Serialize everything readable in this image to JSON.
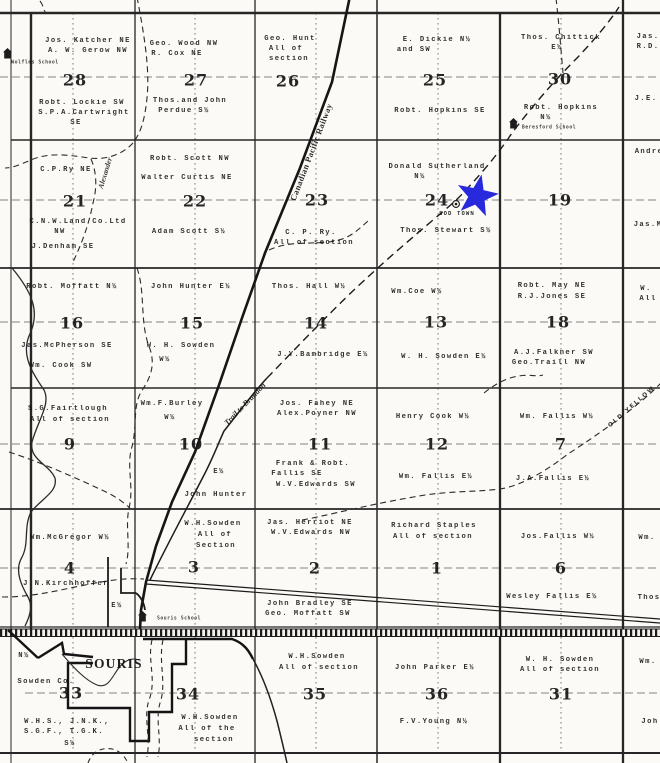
{
  "palette": {
    "paper": "#fbfaf6",
    "ink": "#1c1c1c",
    "grid": "#262626",
    "quarter_dash": "#5d5d5d",
    "star": "#2828dc"
  },
  "star": {
    "color": "#2828dc"
  },
  "schools": [
    {
      "name": "wolfles-school",
      "label": "Wolfles School",
      "icon_x": 3,
      "icon_y": 46,
      "label_x": 35,
      "label_y": 63
    },
    {
      "name": "beresford-school",
      "label": "Beresford School",
      "icon_x": 509,
      "icon_y": 116,
      "label_x": 549,
      "label_y": 128
    },
    {
      "name": "souris-school",
      "label": "Souris School",
      "icon_x": 138,
      "icon_y": 609,
      "label_x": 179,
      "label_y": 619
    }
  ],
  "labels": [
    {
      "name": "s28-owner-ne",
      "text": "Jos. Katcher NE",
      "x": 88,
      "y": 41
    },
    {
      "name": "s28-owner-nw",
      "text": "A. W. Gerow  NW",
      "x": 88,
      "y": 51
    },
    {
      "name": "s28-number",
      "text": "28",
      "x": 75,
      "y": 80,
      "kind": "number"
    },
    {
      "name": "s28-owner-sw",
      "text": "Robt. Lockie SW",
      "x": 82,
      "y": 103
    },
    {
      "name": "s28-owner-se",
      "text": "S.P.A.Cartwright",
      "x": 84,
      "y": 113
    },
    {
      "name": "s28-owner-se-2",
      "text": "SE",
      "x": 76,
      "y": 123
    },
    {
      "name": "s27-owner-nw",
      "text": "Geo. Wood  NW",
      "x": 184,
      "y": 44
    },
    {
      "name": "s27-owner-ne",
      "text": "R. Cox  NE",
      "x": 177,
      "y": 54
    },
    {
      "name": "s27-number",
      "text": "27",
      "x": 196,
      "y": 80,
      "kind": "number"
    },
    {
      "name": "s27-owner-s",
      "text": "Thos.and John",
      "x": 190,
      "y": 101
    },
    {
      "name": "s27-owner-s-2",
      "text": "Perdue  S½",
      "x": 184,
      "y": 111
    },
    {
      "name": "s26-owner-1",
      "text": "Geo. Hunt",
      "x": 290,
      "y": 39
    },
    {
      "name": "s26-owner-2",
      "text": "All of",
      "x": 286,
      "y": 49
    },
    {
      "name": "s26-owner-3",
      "text": "section",
      "x": 289,
      "y": 59
    },
    {
      "name": "s26-number",
      "text": "26",
      "x": 288,
      "y": 81,
      "kind": "number"
    },
    {
      "name": "s25-owner-n",
      "text": "E. Dickie N½",
      "x": 437,
      "y": 40
    },
    {
      "name": "s25-owner-n-2",
      "text": "and SW",
      "x": 414,
      "y": 50
    },
    {
      "name": "s25-number",
      "text": "25",
      "x": 435,
      "y": 80,
      "kind": "number"
    },
    {
      "name": "s25-owner-se",
      "text": "Robt. Hopkins SE",
      "x": 440,
      "y": 111
    },
    {
      "name": "s30-owner-e",
      "text": "Thos. Chittick",
      "x": 561,
      "y": 38
    },
    {
      "name": "s30-owner-e-2",
      "text": "E½",
      "x": 557,
      "y": 48
    },
    {
      "name": "s30-number",
      "text": "30",
      "x": 560,
      "y": 79,
      "kind": "number"
    },
    {
      "name": "s30-owner-n",
      "text": "Robt. Hopkins",
      "x": 561,
      "y": 108
    },
    {
      "name": "s30-owner-n-2",
      "text": "N½",
      "x": 546,
      "y": 118
    },
    {
      "name": "edge-ne-owner-1",
      "text": "Jas.",
      "x": 648,
      "y": 37
    },
    {
      "name": "edge-ne-owner-2",
      "text": "R.D.",
      "x": 648,
      "y": 47
    },
    {
      "name": "edge-ne-owner-3",
      "text": "J.E.",
      "x": 646,
      "y": 99
    },
    {
      "name": "s21-owner-ne",
      "text": "C.P.Ry  NE",
      "x": 66,
      "y": 170
    },
    {
      "name": "s21-number",
      "text": "21",
      "x": 75,
      "y": 201,
      "kind": "number"
    },
    {
      "name": "s21-owner-nw",
      "text": "C.N.W.Land Co.Ltd",
      "x": 78,
      "y": 222
    },
    {
      "name": "s21-owner-nw-2",
      "text": "NW",
      "x": 60,
      "y": 232
    },
    {
      "name": "s21-owner-se",
      "text": "J.Denham  SE",
      "x": 63,
      "y": 247
    },
    {
      "name": "alexander-trail-label",
      "text": "Alexander",
      "x": 105,
      "y": 173,
      "kind": "alex",
      "rot": -73
    },
    {
      "name": "s22-owner-nw",
      "text": "Robt. Scott  NW",
      "x": 190,
      "y": 159
    },
    {
      "name": "s22-owner-ne",
      "text": "Walter Curtis NE",
      "x": 187,
      "y": 178
    },
    {
      "name": "s22-number",
      "text": "22",
      "x": 195,
      "y": 201,
      "kind": "number"
    },
    {
      "name": "s22-owner-s",
      "text": "Adam Scott  S½",
      "x": 189,
      "y": 232
    },
    {
      "name": "cp-railway-label",
      "text": "Canadian Pacific Railway",
      "x": 311,
      "y": 152,
      "kind": "rail",
      "rot": -69
    },
    {
      "name": "s23-number",
      "text": "23",
      "x": 317,
      "y": 200,
      "kind": "number"
    },
    {
      "name": "s23-owner-1",
      "text": "C. P. Ry.",
      "x": 311,
      "y": 233
    },
    {
      "name": "s23-owner-2",
      "text": "All of section",
      "x": 314,
      "y": 243
    },
    {
      "name": "s24-owner-n",
      "text": "Donald Sutherland",
      "x": 437,
      "y": 167
    },
    {
      "name": "s24-owner-n-2",
      "text": "N½",
      "x": 420,
      "y": 177
    },
    {
      "name": "s24-number",
      "text": "24",
      "x": 437,
      "y": 200,
      "kind": "number"
    },
    {
      "name": "sod-town-label",
      "text": "SOD TOWN",
      "x": 457,
      "y": 214,
      "kind": "tiny"
    },
    {
      "name": "s24-owner-s",
      "text": "Thos. Stewart S½",
      "x": 446,
      "y": 231
    },
    {
      "name": "s19-number",
      "text": "19",
      "x": 560,
      "y": 200,
      "kind": "number"
    },
    {
      "name": "edge-e-owner-1",
      "text": "Andre",
      "x": 649,
      "y": 152
    },
    {
      "name": "edge-e-owner-2",
      "text": "Jas.M",
      "x": 648,
      "y": 225
    },
    {
      "name": "s16-owner-n",
      "text": "Robt. Moffatt N½",
      "x": 72,
      "y": 287
    },
    {
      "name": "s16-number",
      "text": "16",
      "x": 72,
      "y": 323,
      "kind": "number"
    },
    {
      "name": "s16-owner-se",
      "text": "Jas.McPherson SE",
      "x": 67,
      "y": 346
    },
    {
      "name": "s16-owner-sw",
      "text": "Wm. Cook  SW",
      "x": 61,
      "y": 366
    },
    {
      "name": "s15-owner-e",
      "text": "John Hunter  E½",
      "x": 191,
      "y": 287
    },
    {
      "name": "s15-number",
      "text": "15",
      "x": 192,
      "y": 323,
      "kind": "number"
    },
    {
      "name": "s15-owner-w",
      "text": "W. H. Sowden",
      "x": 181,
      "y": 346
    },
    {
      "name": "s15-owner-w-2",
      "text": "W½",
      "x": 165,
      "y": 360
    },
    {
      "name": "s14-owner-w",
      "text": "Thos. Hall  W½",
      "x": 309,
      "y": 287
    },
    {
      "name": "s14-number",
      "text": "14",
      "x": 316,
      "y": 323,
      "kind": "number"
    },
    {
      "name": "s14-owner-e",
      "text": "J.Y.Bambridge E½",
      "x": 323,
      "y": 355
    },
    {
      "name": "s13-owner-w",
      "text": "Wm.Coe  W½",
      "x": 417,
      "y": 292
    },
    {
      "name": "s13-number",
      "text": "13",
      "x": 436,
      "y": 322,
      "kind": "number"
    },
    {
      "name": "s13-owner-e",
      "text": "W. H. Sowden  E½",
      "x": 444,
      "y": 357
    },
    {
      "name": "s18-owner-ne",
      "text": "Robt. May  NE",
      "x": 552,
      "y": 286
    },
    {
      "name": "s18-owner-se",
      "text": "R.J.Jones  SE",
      "x": 552,
      "y": 297
    },
    {
      "name": "s18-number",
      "text": "18",
      "x": 558,
      "y": 322,
      "kind": "number"
    },
    {
      "name": "s18-owner-sw",
      "text": "A.J.Falkner  SW",
      "x": 554,
      "y": 353
    },
    {
      "name": "s18-owner-nw",
      "text": "Geo.Traill  NW",
      "x": 549,
      "y": 363
    },
    {
      "name": "edge-e-owner-3",
      "text": "W.",
      "x": 646,
      "y": 289
    },
    {
      "name": "edge-e-owner-4",
      "text": "All",
      "x": 648,
      "y": 299
    },
    {
      "name": "s9-owner-1",
      "text": "S.G.Fairtlough",
      "x": 68,
      "y": 409
    },
    {
      "name": "s9-owner-2",
      "text": "All of section",
      "x": 70,
      "y": 420
    },
    {
      "name": "s9-number",
      "text": "9",
      "x": 70,
      "y": 444,
      "kind": "number"
    },
    {
      "name": "s10-owner-w",
      "text": "Wm.F.Burley",
      "x": 172,
      "y": 404
    },
    {
      "name": "s10-owner-w-2",
      "text": "W½",
      "x": 170,
      "y": 418
    },
    {
      "name": "s10-number",
      "text": "10",
      "x": 191,
      "y": 444,
      "kind": "number"
    },
    {
      "name": "trail-to-brandon-label",
      "text": "Trail to Brandon",
      "x": 245,
      "y": 404,
      "kind": "trail",
      "rot": -46
    },
    {
      "name": "s10-owner-e-2",
      "text": "E½",
      "x": 219,
      "y": 472
    },
    {
      "name": "s10-owner-e",
      "text": "John Hunter",
      "x": 216,
      "y": 495
    },
    {
      "name": "s11-owner-ne",
      "text": "Jos. Fahey NE",
      "x": 317,
      "y": 404
    },
    {
      "name": "s11-owner-nw",
      "text": "Alex.Poyner NW",
      "x": 317,
      "y": 414
    },
    {
      "name": "s11-number",
      "text": "11",
      "x": 320,
      "y": 444,
      "kind": "number"
    },
    {
      "name": "s11-owner-se",
      "text": "Frank & Robt.",
      "x": 313,
      "y": 464
    },
    {
      "name": "s11-owner-se-2",
      "text": "Fallis SE",
      "x": 297,
      "y": 474
    },
    {
      "name": "s11-owner-sw",
      "text": "W.V.Edwards SW",
      "x": 316,
      "y": 485
    },
    {
      "name": "s12-owner-w",
      "text": "Henry Cook  W½",
      "x": 433,
      "y": 417
    },
    {
      "name": "s12-number",
      "text": "12",
      "x": 437,
      "y": 444,
      "kind": "number"
    },
    {
      "name": "s12-owner-e",
      "text": "Wm. Fallis  E½",
      "x": 436,
      "y": 477
    },
    {
      "name": "s7-owner-w",
      "text": "Wm. Fallis  W½",
      "x": 557,
      "y": 417
    },
    {
      "name": "s7-number",
      "text": "7",
      "x": 561,
      "y": 444,
      "kind": "number"
    },
    {
      "name": "s7-owner-e",
      "text": "J.A.Fallis  E½",
      "x": 553,
      "y": 479
    },
    {
      "name": "old-yellow-trail-label",
      "text": "OLD YELLOW",
      "x": 632,
      "y": 407,
      "kind": "oldyellow",
      "rot": -41
    },
    {
      "name": "s4-owner-w",
      "text": "Wm.McGregor W½",
      "x": 70,
      "y": 538
    },
    {
      "name": "s4-number",
      "text": "4",
      "x": 70,
      "y": 568,
      "kind": "number"
    },
    {
      "name": "s4-owner-2",
      "text": "J.N.Kirchhoffer",
      "x": 66,
      "y": 584
    },
    {
      "name": "s4-owner-3",
      "text": "E½",
      "x": 117,
      "y": 606
    },
    {
      "name": "s3-owner-1",
      "text": "W.H.Sowden",
      "x": 213,
      "y": 524
    },
    {
      "name": "s3-owner-2",
      "text": "All of",
      "x": 215,
      "y": 535
    },
    {
      "name": "s3-owner-3",
      "text": "Section",
      "x": 216,
      "y": 546
    },
    {
      "name": "s3-number",
      "text": "3",
      "x": 194,
      "y": 567,
      "kind": "number"
    },
    {
      "name": "s2-owner-ne",
      "text": "Jas. Herriot NE",
      "x": 310,
      "y": 523
    },
    {
      "name": "s2-owner-nw",
      "text": "W.V.Edwards NW",
      "x": 311,
      "y": 533
    },
    {
      "name": "s2-number",
      "text": "2",
      "x": 315,
      "y": 568,
      "kind": "number"
    },
    {
      "name": "s2-owner-se",
      "text": "John Bradley SE",
      "x": 310,
      "y": 604
    },
    {
      "name": "s2-owner-sw",
      "text": "Geo. Moffatt SW",
      "x": 308,
      "y": 614
    },
    {
      "name": "s1-owner-1",
      "text": "Richard Staples",
      "x": 434,
      "y": 526
    },
    {
      "name": "s1-owner-2",
      "text": "All of section",
      "x": 433,
      "y": 537
    },
    {
      "name": "s1-number",
      "text": "1",
      "x": 437,
      "y": 568,
      "kind": "number"
    },
    {
      "name": "s6-owner-w",
      "text": "Jos.Fallis  W½",
      "x": 558,
      "y": 537
    },
    {
      "name": "s6-number",
      "text": "6",
      "x": 561,
      "y": 568,
      "kind": "number"
    },
    {
      "name": "s6-owner-e",
      "text": "Wesley Fallis E½",
      "x": 552,
      "y": 597
    },
    {
      "name": "edge-e-owner-5",
      "text": "Wm.",
      "x": 647,
      "y": 538
    },
    {
      "name": "edge-e-owner-6",
      "text": "Thos",
      "x": 649,
      "y": 598
    },
    {
      "name": "edge-w-owner-1",
      "text": "N½",
      "x": 24,
      "y": 656
    },
    {
      "name": "souris-town-label",
      "text": "SOURIS",
      "x": 114,
      "y": 664,
      "kind": "town"
    },
    {
      "name": "sowden-co-label",
      "text": "Sowden Co.",
      "x": 46,
      "y": 682
    },
    {
      "name": "s33-number",
      "text": "33",
      "x": 71,
      "y": 693,
      "kind": "number"
    },
    {
      "name": "s33-owner-1",
      "text": "W.H.S., J.N.K.,",
      "x": 67,
      "y": 722
    },
    {
      "name": "s33-owner-2",
      "text": "S.G.F., T.G.K.",
      "x": 64,
      "y": 732
    },
    {
      "name": "s33-owner-3",
      "text": "S½",
      "x": 70,
      "y": 744
    },
    {
      "name": "s34-number",
      "text": "34",
      "x": 188,
      "y": 694,
      "kind": "number"
    },
    {
      "name": "s34-owner-1",
      "text": "W.H.Sowden",
      "x": 210,
      "y": 718
    },
    {
      "name": "s34-owner-2",
      "text": "All of the",
      "x": 207,
      "y": 729
    },
    {
      "name": "s34-owner-3",
      "text": "section",
      "x": 214,
      "y": 740
    },
    {
      "name": "s35-owner-1",
      "text": "W.H.Sowden",
      "x": 317,
      "y": 657
    },
    {
      "name": "s35-owner-2",
      "text": "All of section",
      "x": 319,
      "y": 668
    },
    {
      "name": "s35-number",
      "text": "35",
      "x": 315,
      "y": 694,
      "kind": "number"
    },
    {
      "name": "s36-owner-1",
      "text": "John Parker  E½",
      "x": 435,
      "y": 668
    },
    {
      "name": "s36-number",
      "text": "36",
      "x": 437,
      "y": 694,
      "kind": "number"
    },
    {
      "name": "s36-owner-2",
      "text": "F.V.Young  N½",
      "x": 434,
      "y": 722
    },
    {
      "name": "s31-owner-1",
      "text": "W. H. Sowden",
      "x": 560,
      "y": 660
    },
    {
      "name": "s31-owner-2",
      "text": "All of section",
      "x": 560,
      "y": 670
    },
    {
      "name": "s31-number",
      "text": "31",
      "x": 561,
      "y": 694,
      "kind": "number"
    },
    {
      "name": "edge-e-owner-7",
      "text": "Wm.",
      "x": 648,
      "y": 662
    },
    {
      "name": "edge-e-owner-8",
      "text": "Joh",
      "x": 650,
      "y": 722
    }
  ]
}
